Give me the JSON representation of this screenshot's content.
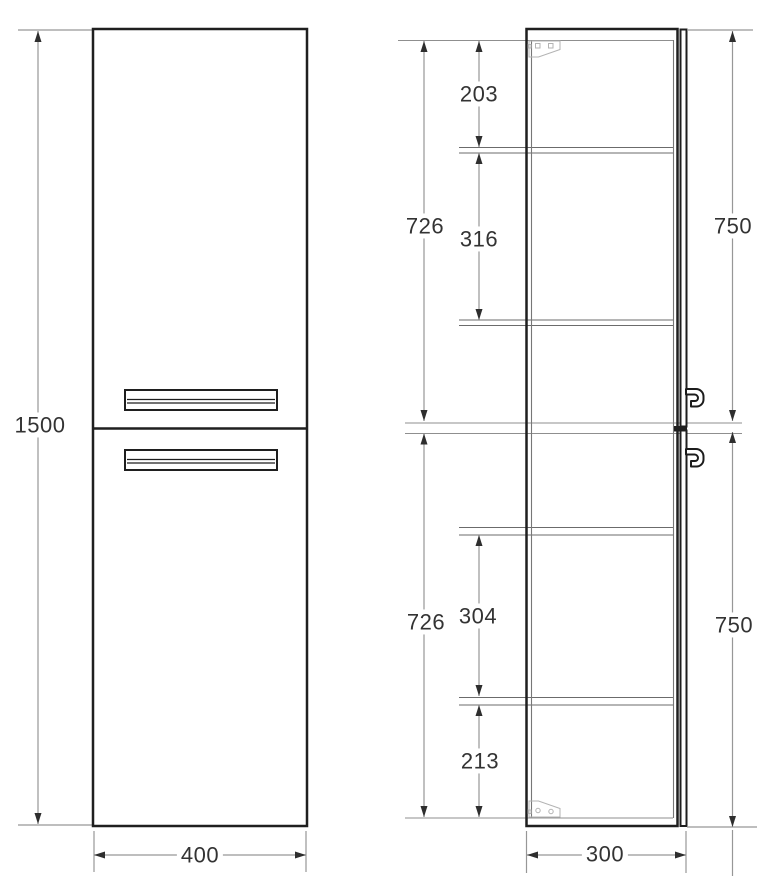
{
  "drawing": {
    "front_view": {
      "height": "1500",
      "width": "400"
    },
    "side_view": {
      "depth": "300",
      "upper_section": {
        "interior_height": "726",
        "top_compartment": "203",
        "middle_compartment": "316",
        "door_height": "750"
      },
      "lower_section": {
        "interior_height": "726",
        "middle_compartment": "304",
        "bottom_compartment": "213",
        "door_height": "750"
      }
    }
  }
}
